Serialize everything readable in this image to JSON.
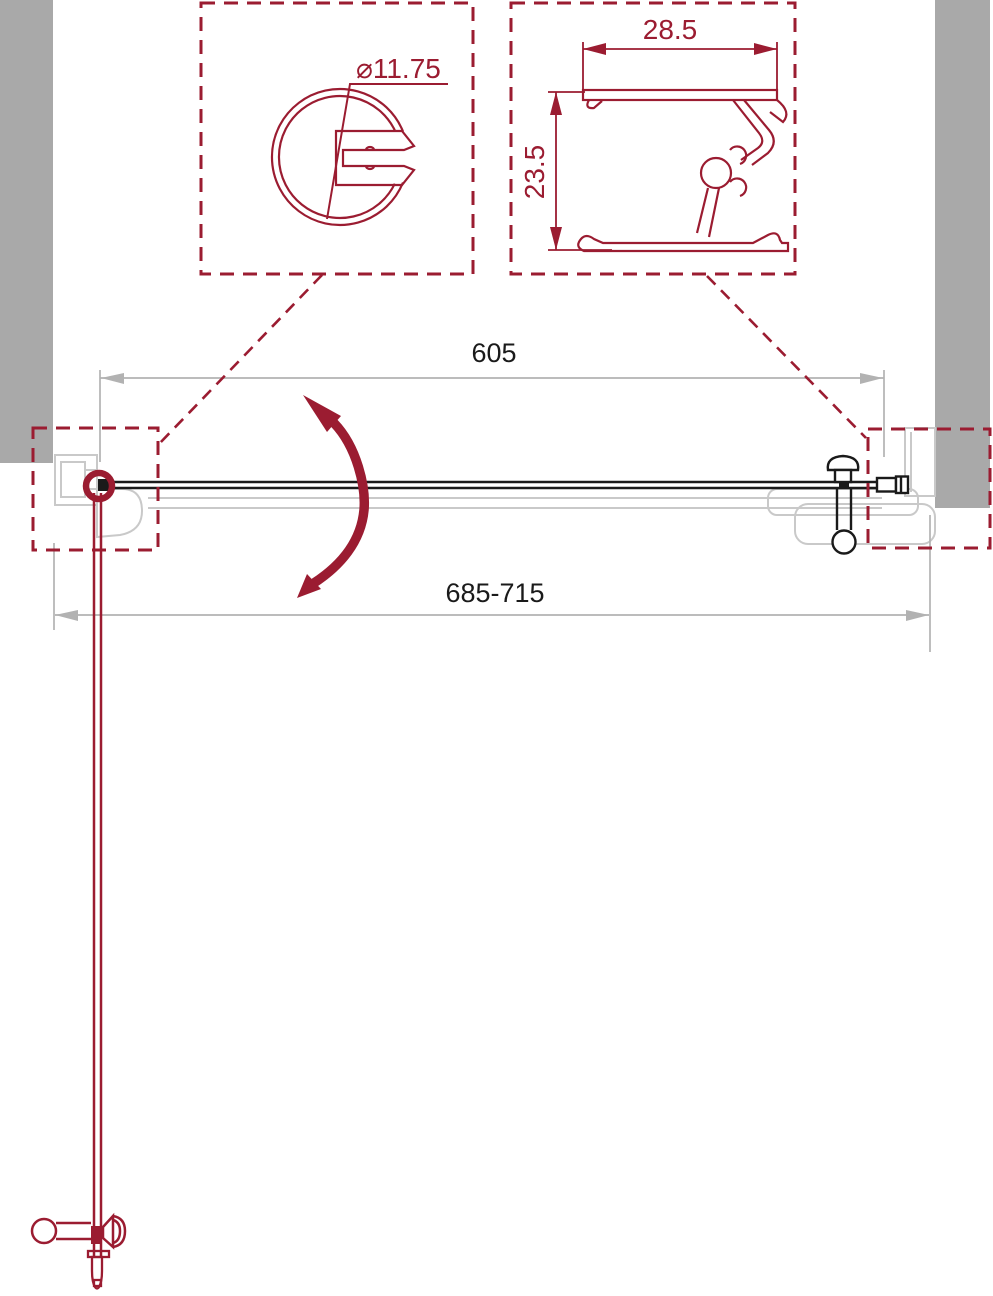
{
  "drawing": {
    "dimensions": {
      "glass_width": "605",
      "installation_range": "685-715",
      "hinge_profile_diameter": "⌀11.75",
      "wall_profile_width": "28.5",
      "wall_profile_height": "23.5"
    },
    "colors": {
      "accent_red": "#9b1c31",
      "wall_gray": "#a9a9a9",
      "ghost_gray": "#c9c9c9",
      "dimension_gray": "#b2b2b2",
      "ink_black": "#1a1a1a",
      "background": "#ffffff"
    }
  }
}
